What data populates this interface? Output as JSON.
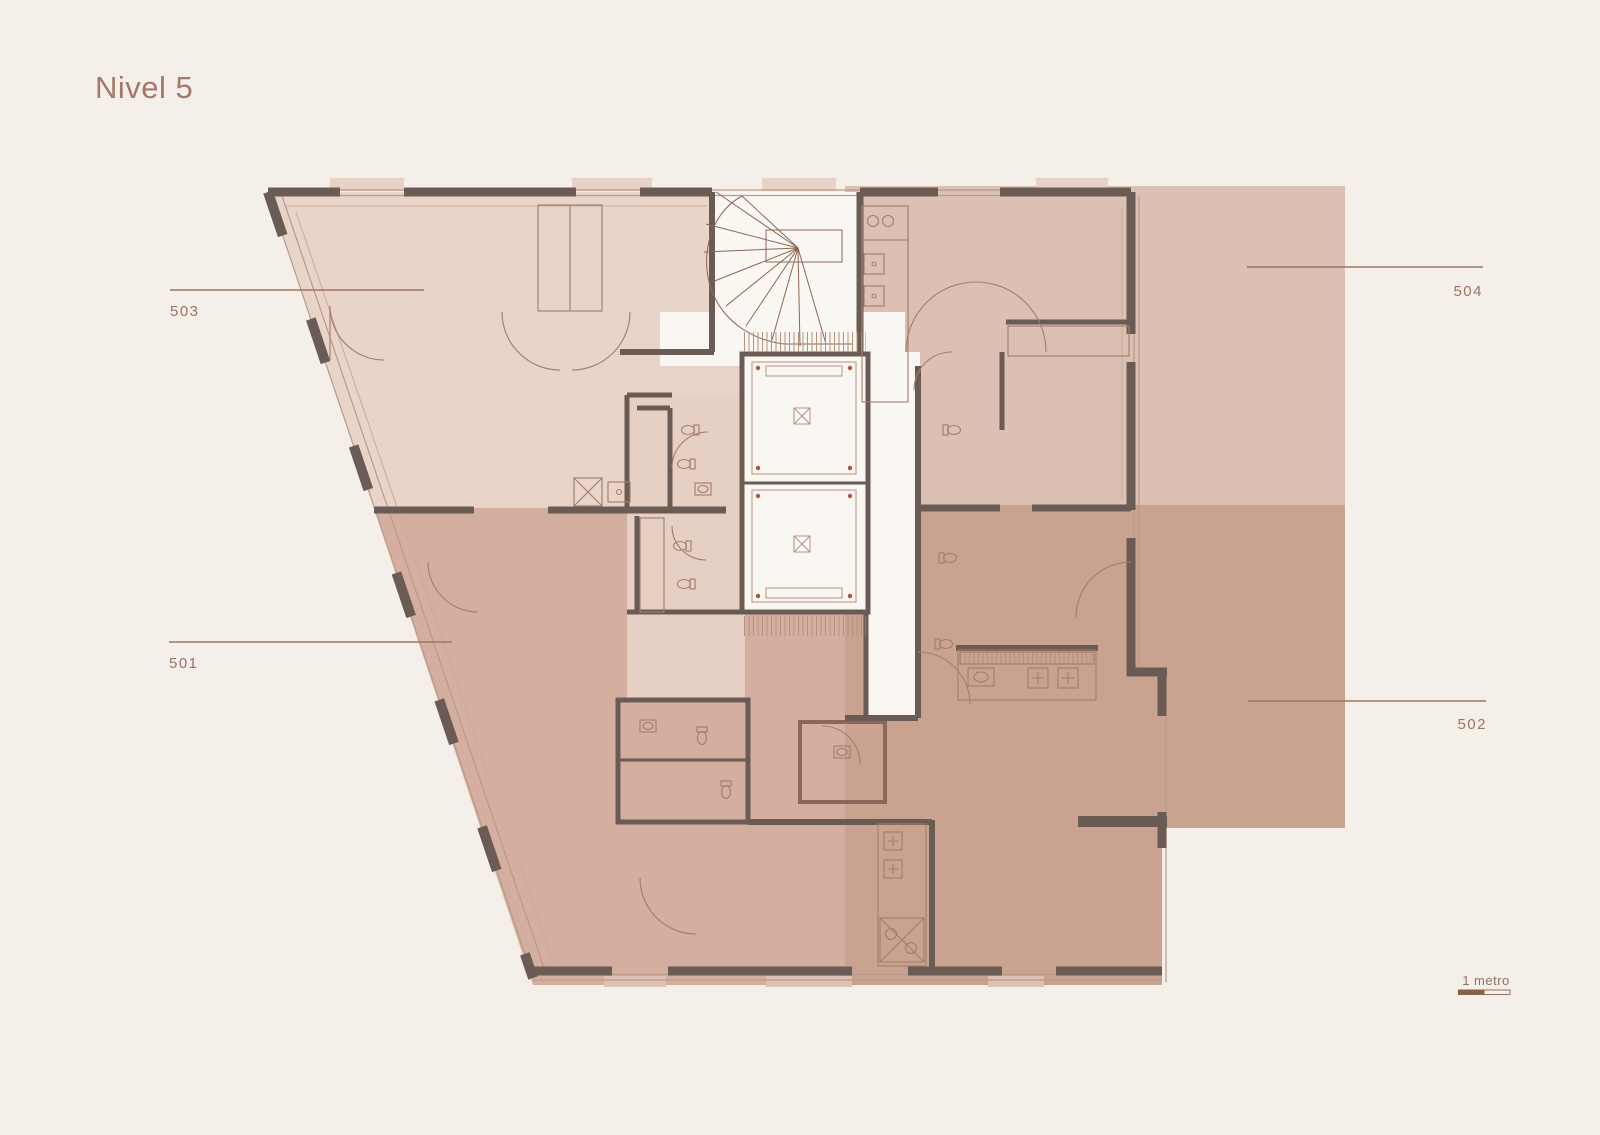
{
  "page": {
    "title": "Nivel 5"
  },
  "units": [
    {
      "id": "503",
      "label_side": "left"
    },
    {
      "id": "501",
      "label_side": "left"
    },
    {
      "id": "504",
      "label_side": "right"
    },
    {
      "id": "502",
      "label_side": "right"
    }
  ],
  "scale_bar": {
    "label": "1 metro"
  },
  "colors": {
    "background": "#f4efe9",
    "unit_503_fill": "#e9d4c9",
    "unit_504_fill": "#dcc0b4",
    "unit_501_fill": "#d4ae9e",
    "unit_502_fill": "#c9a390",
    "core_fill": "#faf7f2",
    "bath_column_fill": "#e6cfc3",
    "bath_502_fill": "#bd9a88",
    "wall": "#6a5c54",
    "detail_line": "#a37c6a",
    "leader_line": "#a1745f",
    "label_text": "#9d7263",
    "title_text": "#a5786a",
    "scale_dark": "#8a5f4c"
  }
}
